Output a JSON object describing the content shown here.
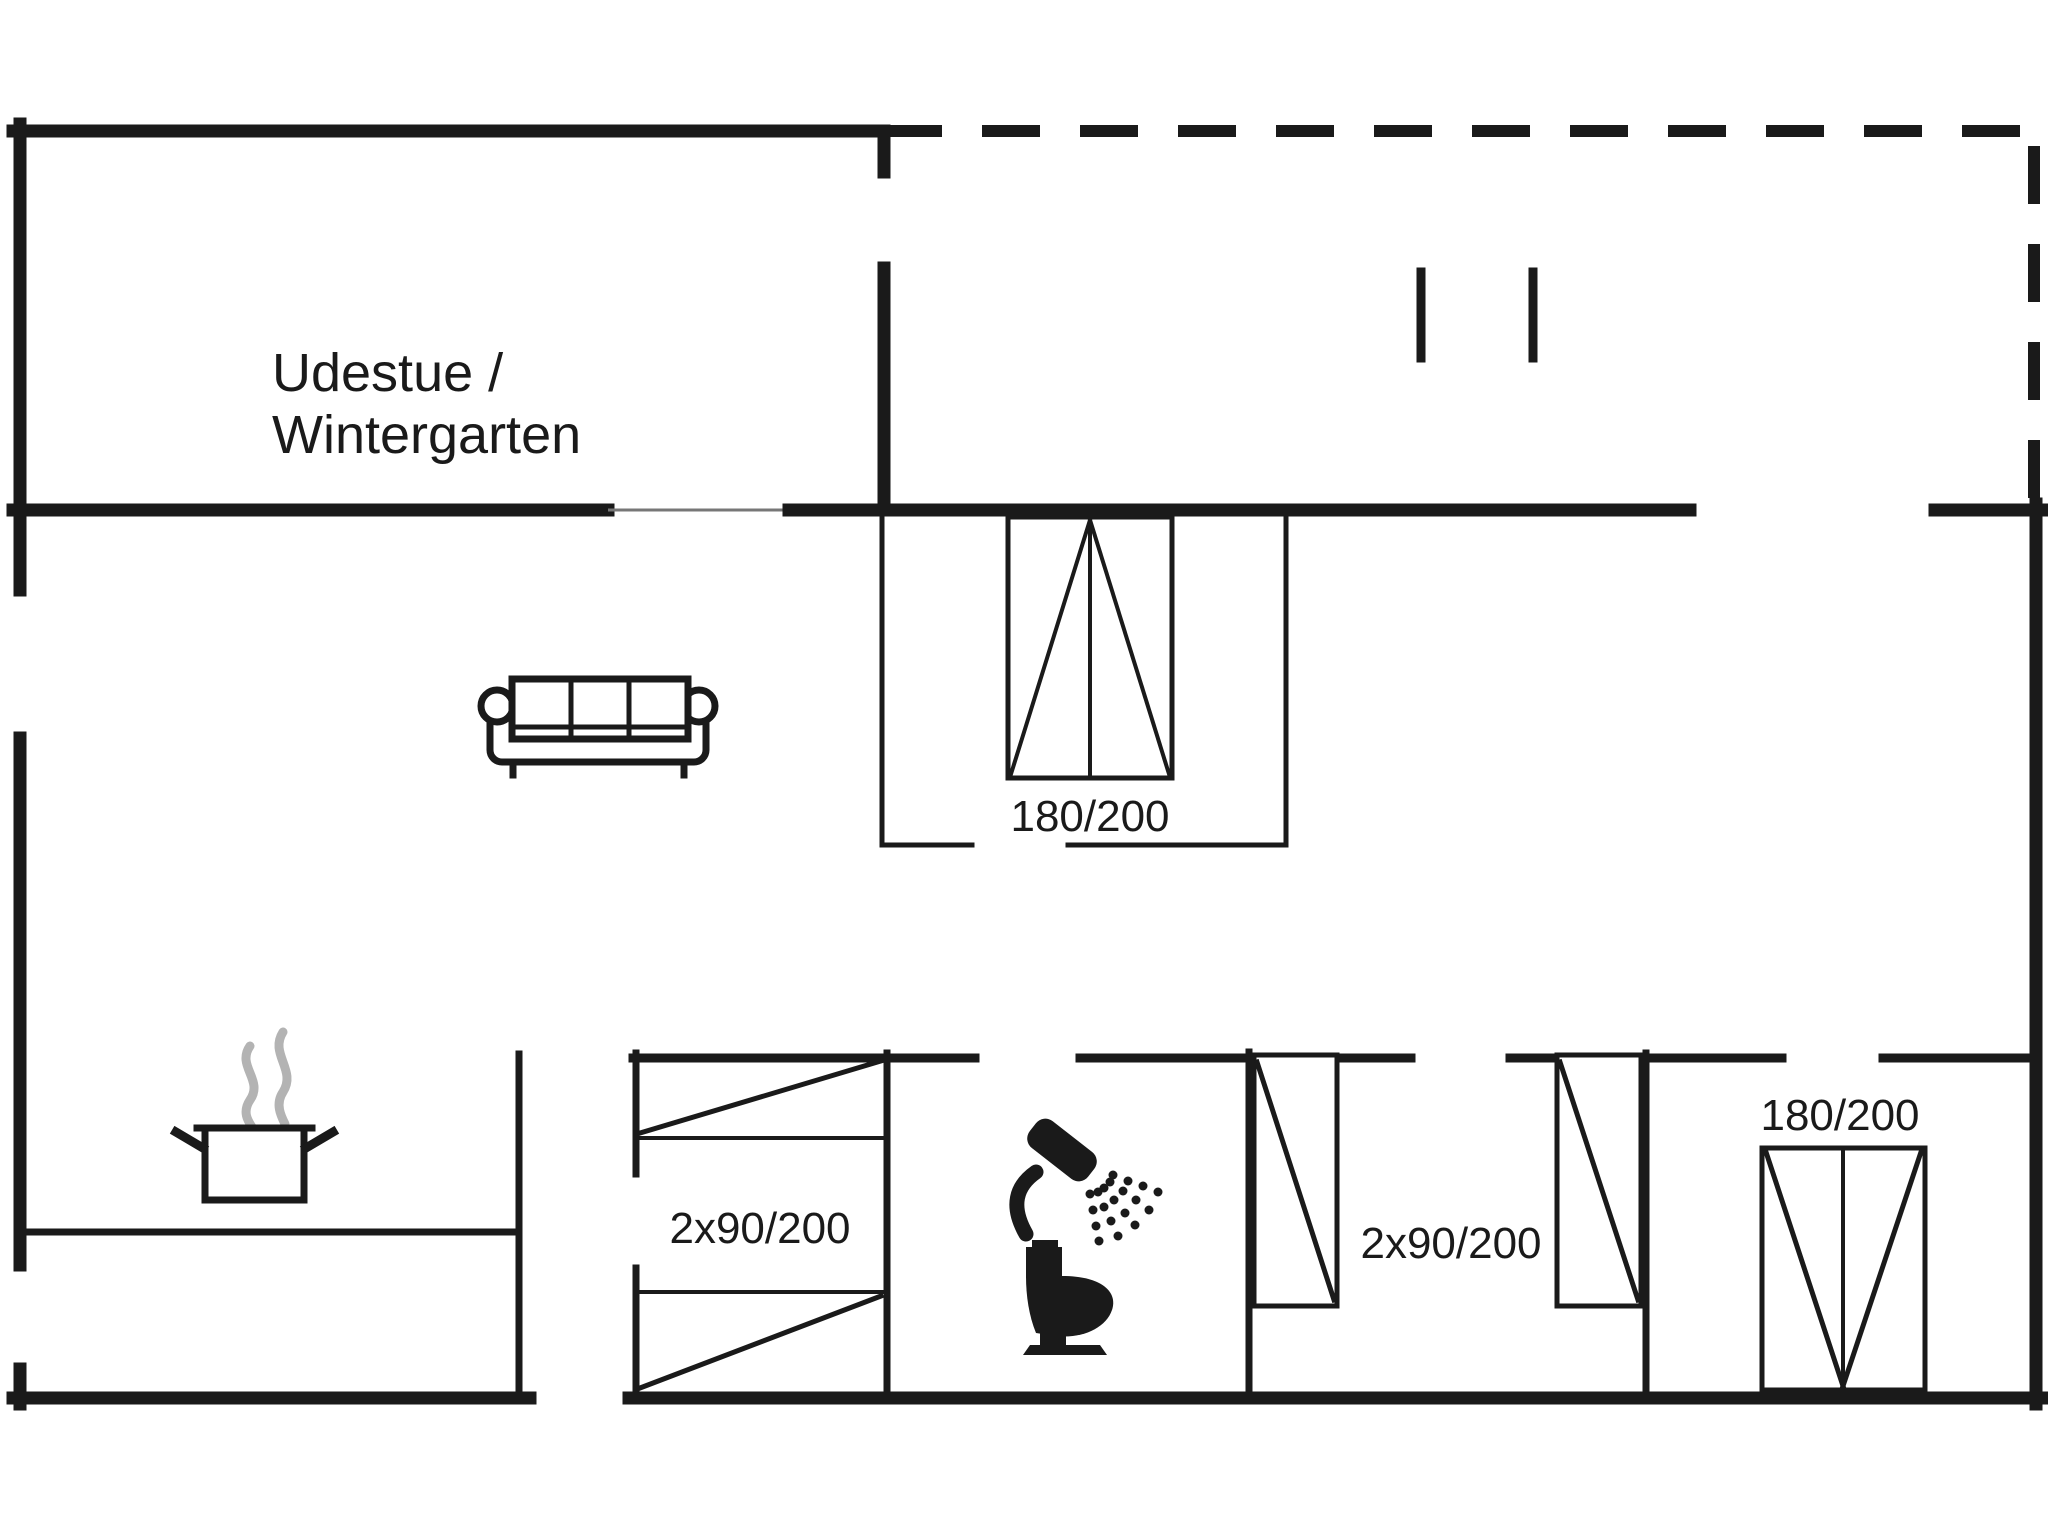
{
  "canvas": {
    "width": 2048,
    "height": 1536,
    "background": "#ffffff"
  },
  "palette": {
    "wall_color": "#1a1a1a",
    "steam_color": "#b3b3b3",
    "text_color": "#1a1a1a"
  },
  "rooms": {
    "udestue": {
      "label_line1": "Udestue /",
      "label_line2": "Wintergarten"
    },
    "middle_bedroom": {
      "bed_label": "180/200"
    },
    "left_bedroom": {
      "bed_label": "2x90/200"
    },
    "right_middle_bedroom": {
      "bed_label": "2x90/200"
    },
    "right_bedroom": {
      "bed_label": "180/200"
    }
  },
  "furniture_icons": [
    "sofa-icon",
    "double-bed-icon",
    "bunk-bed-icon",
    "single-bed-icon",
    "double-bed-vertical-icon",
    "cooking-pot-icon",
    "steam-icon",
    "shower-icon",
    "toilet-icon"
  ]
}
